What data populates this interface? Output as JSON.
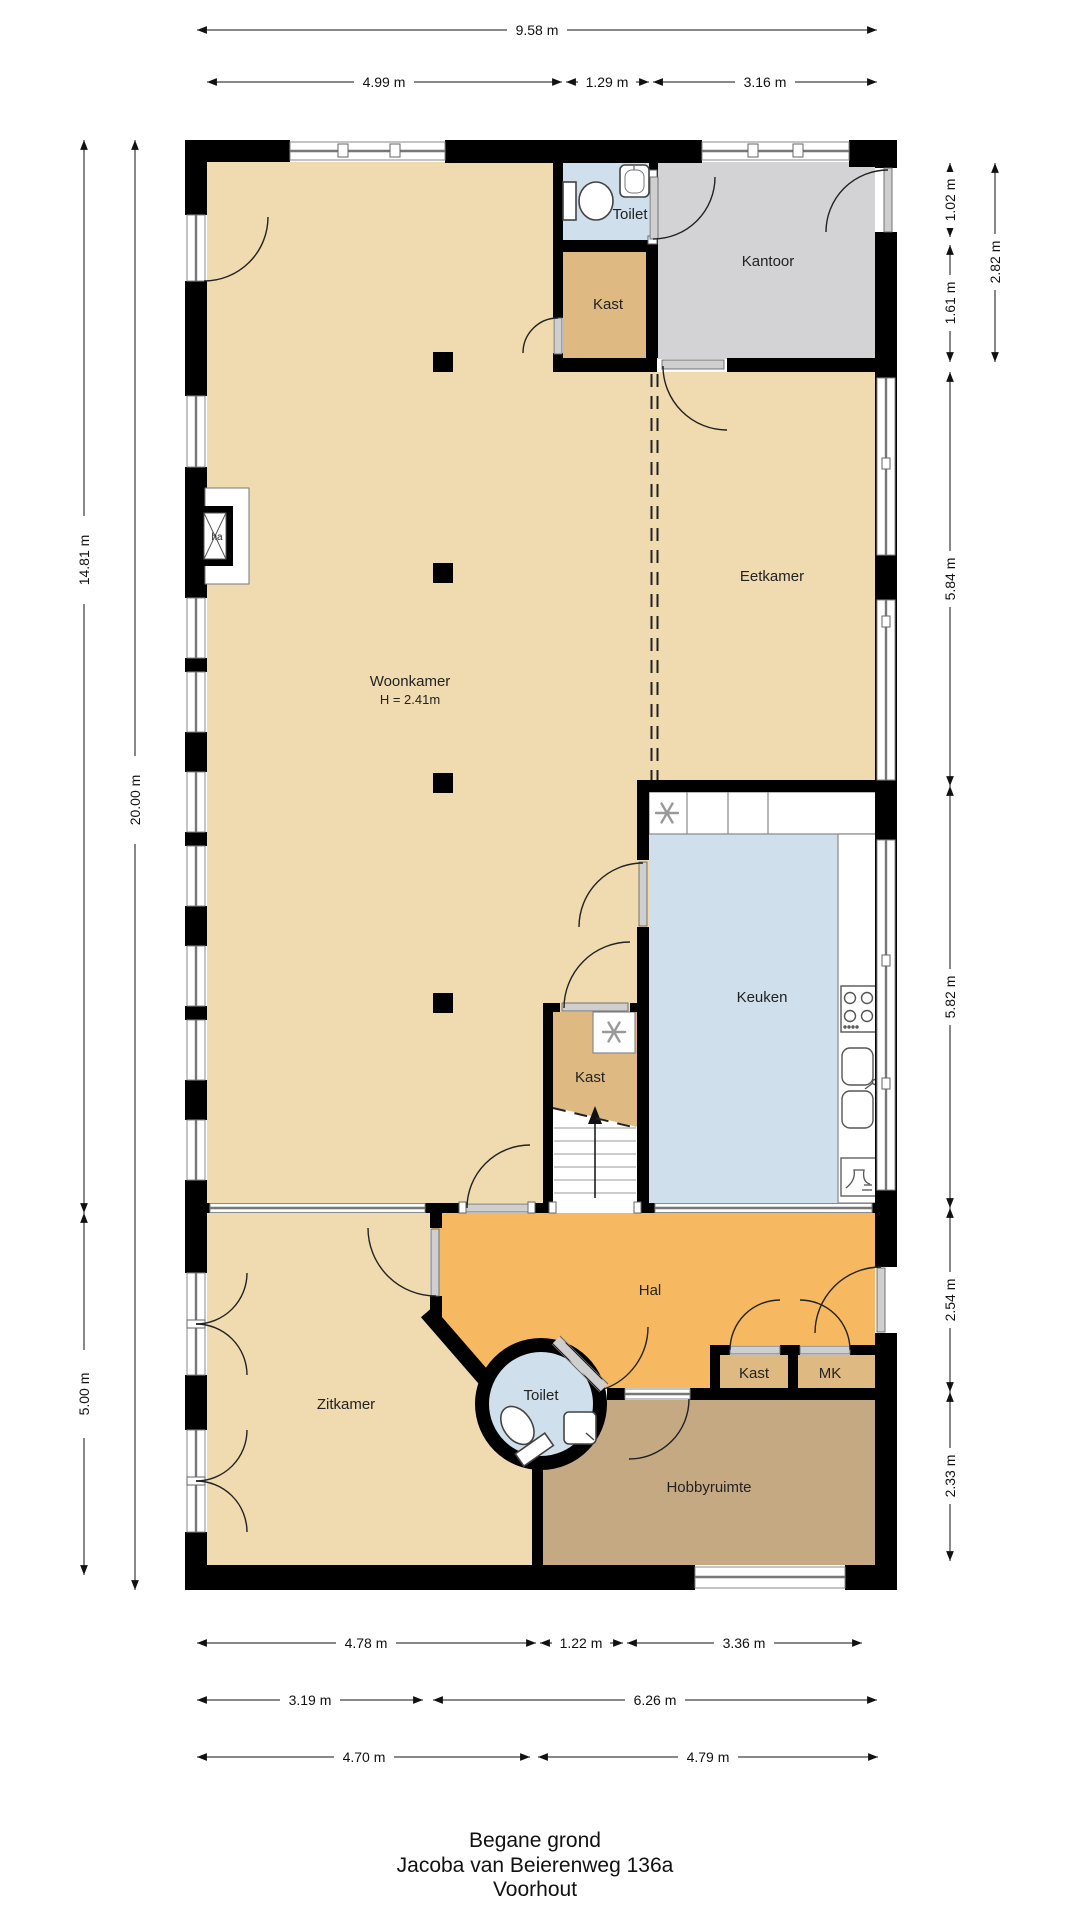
{
  "title": {
    "line1": "Begane grond",
    "line2": "Jacoba van Beierenweg 136a",
    "line3": "Voorhout"
  },
  "rooms": {
    "toilet_top": "Toilet",
    "kantoor": "Kantoor",
    "kast_top": "Kast",
    "eetkamer": "Eetkamer",
    "woonkamer": "Woonkamer",
    "woonkamer_height": "H = 2.41m",
    "keuken": "Keuken",
    "kast_mid": "Kast",
    "hal": "Hal",
    "toilet_round": "Toilet",
    "kast_hal": "Kast",
    "mk": "MK",
    "zitkamer": "Zitkamer",
    "hobbyruimte": "Hobbyruimte",
    "fireplace": "ha"
  },
  "dims": {
    "top": [
      "9.58 m",
      "4.99 m",
      "1.29 m",
      "3.16 m"
    ],
    "left": [
      "14.81 m",
      "20.00 m",
      "5.00 m"
    ],
    "right": [
      "1.02 m",
      "1.61 m",
      "2.82 m",
      "5.84 m",
      "5.82 m",
      "2.54 m",
      "2.33 m"
    ],
    "bottom": [
      "4.78 m",
      "1.22 m",
      "3.36 m",
      "3.19 m",
      "6.26 m",
      "4.70 m",
      "4.79 m"
    ]
  },
  "colors": {
    "floor_main": "#f0dbb1",
    "floor_kast": "#deba82",
    "floor_hal": "#f6b961",
    "floor_water": "#cfdfec",
    "floor_kantoor": "#d3d3d5",
    "floor_hobby": "#c5a983",
    "wall": "#000000"
  }
}
